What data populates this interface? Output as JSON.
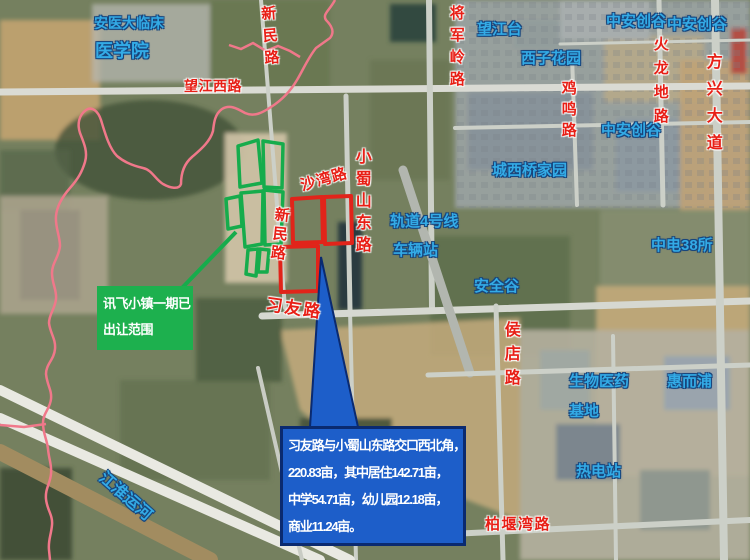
{
  "map": {
    "place_labels": [
      {
        "t": "安医大临床",
        "x": 94,
        "y": 16,
        "fs": 14
      },
      {
        "t": "医学院",
        "x": 95,
        "y": 42,
        "fs": 18
      },
      {
        "t": "望江台",
        "x": 477,
        "y": 22,
        "fs": 15
      },
      {
        "t": "西子花园",
        "x": 521,
        "y": 51,
        "fs": 15
      },
      {
        "t": "中安创谷",
        "x": 606,
        "y": 14,
        "fs": 15
      },
      {
        "t": "中安创谷",
        "x": 667,
        "y": 17,
        "fs": 15
      },
      {
        "t": "中安创谷",
        "x": 601,
        "y": 123,
        "fs": 15
      },
      {
        "t": "城西桥家园",
        "x": 492,
        "y": 163,
        "fs": 15
      },
      {
        "t": "轨道4号线",
        "x": 390,
        "y": 214,
        "fs": 15
      },
      {
        "t": "车辆站",
        "x": 393,
        "y": 243,
        "fs": 15
      },
      {
        "t": "安全谷",
        "x": 474,
        "y": 279,
        "fs": 15
      },
      {
        "t": "中电38所",
        "x": 651,
        "y": 238,
        "fs": 15
      },
      {
        "t": "生物医药",
        "x": 569,
        "y": 374,
        "fs": 15
      },
      {
        "t": "基地",
        "x": 569,
        "y": 404,
        "fs": 15
      },
      {
        "t": "惠而浦",
        "x": 667,
        "y": 374,
        "fs": 15
      },
      {
        "t": "热电站",
        "x": 576,
        "y": 464,
        "fs": 15
      },
      {
        "t": "江淮运河",
        "x": 106,
        "y": 470,
        "fs": 16,
        "rot": 41
      }
    ],
    "road_labels": [
      {
        "t": "望江西路",
        "x": 184,
        "y": 79,
        "fs": 14,
        "ls": 0.5
      },
      {
        "t": "新民路",
        "x": 259,
        "y": 6,
        "fs": 15,
        "v": 1,
        "ls": 7,
        "rot": -4
      },
      {
        "t": "将军岭路",
        "x": 448,
        "y": 5,
        "fs": 15,
        "v": 1,
        "ls": 7
      },
      {
        "t": "鸡鸣路",
        "x": 560,
        "y": 80,
        "fs": 15,
        "v": 1,
        "ls": 6
      },
      {
        "t": "火龙地路",
        "x": 652,
        "y": 36,
        "fs": 15,
        "v": 1,
        "ls": 9
      },
      {
        "t": "方兴大道",
        "x": 703,
        "y": 53,
        "fs": 16,
        "v": 1,
        "ls": 11
      },
      {
        "t": "沙湾路",
        "x": 299,
        "y": 179,
        "fs": 15,
        "rot": -16,
        "ls": 1
      },
      {
        "t": "小蜀山东路",
        "x": 352,
        "y": 148,
        "fs": 16,
        "v": 1,
        "ls": 6
      },
      {
        "t": "新民路",
        "x": 274,
        "y": 206,
        "fs": 15,
        "v": 1,
        "ls": 4,
        "rot": 6
      },
      {
        "t": "习友路",
        "x": 267,
        "y": 296,
        "fs": 17,
        "rot": 8,
        "ls": 2
      },
      {
        "t": "侯店路",
        "x": 501,
        "y": 321,
        "fs": 16,
        "v": 1,
        "ls": 8
      },
      {
        "t": "柏堰湾路",
        "x": 485,
        "y": 517,
        "fs": 15,
        "ls": 1.5
      }
    ],
    "callouts": {
      "green": {
        "lines": [
          "讯飞小镇一期已",
          "出让范围"
        ]
      },
      "blue": {
        "lines": [
          "习友路与小蜀山东路交口西北角，",
          "220.83亩，其中居住142.71亩，",
          "中学54.71亩，幼儿园12.18亩，",
          "商业11.24亩。"
        ]
      }
    },
    "colors": {
      "place_label": "#33abe6",
      "place_label_outline": "#17457d",
      "road_label": "#e81f16",
      "parcel_green": "#16ac4c",
      "parcel_red": "#e1241a",
      "callout_green_bg": "#1db04e",
      "callout_blue_bg": "#1d5ec9",
      "callout_blue_border": "#0a2a70",
      "boundary_pink": "#f0788a"
    }
  }
}
